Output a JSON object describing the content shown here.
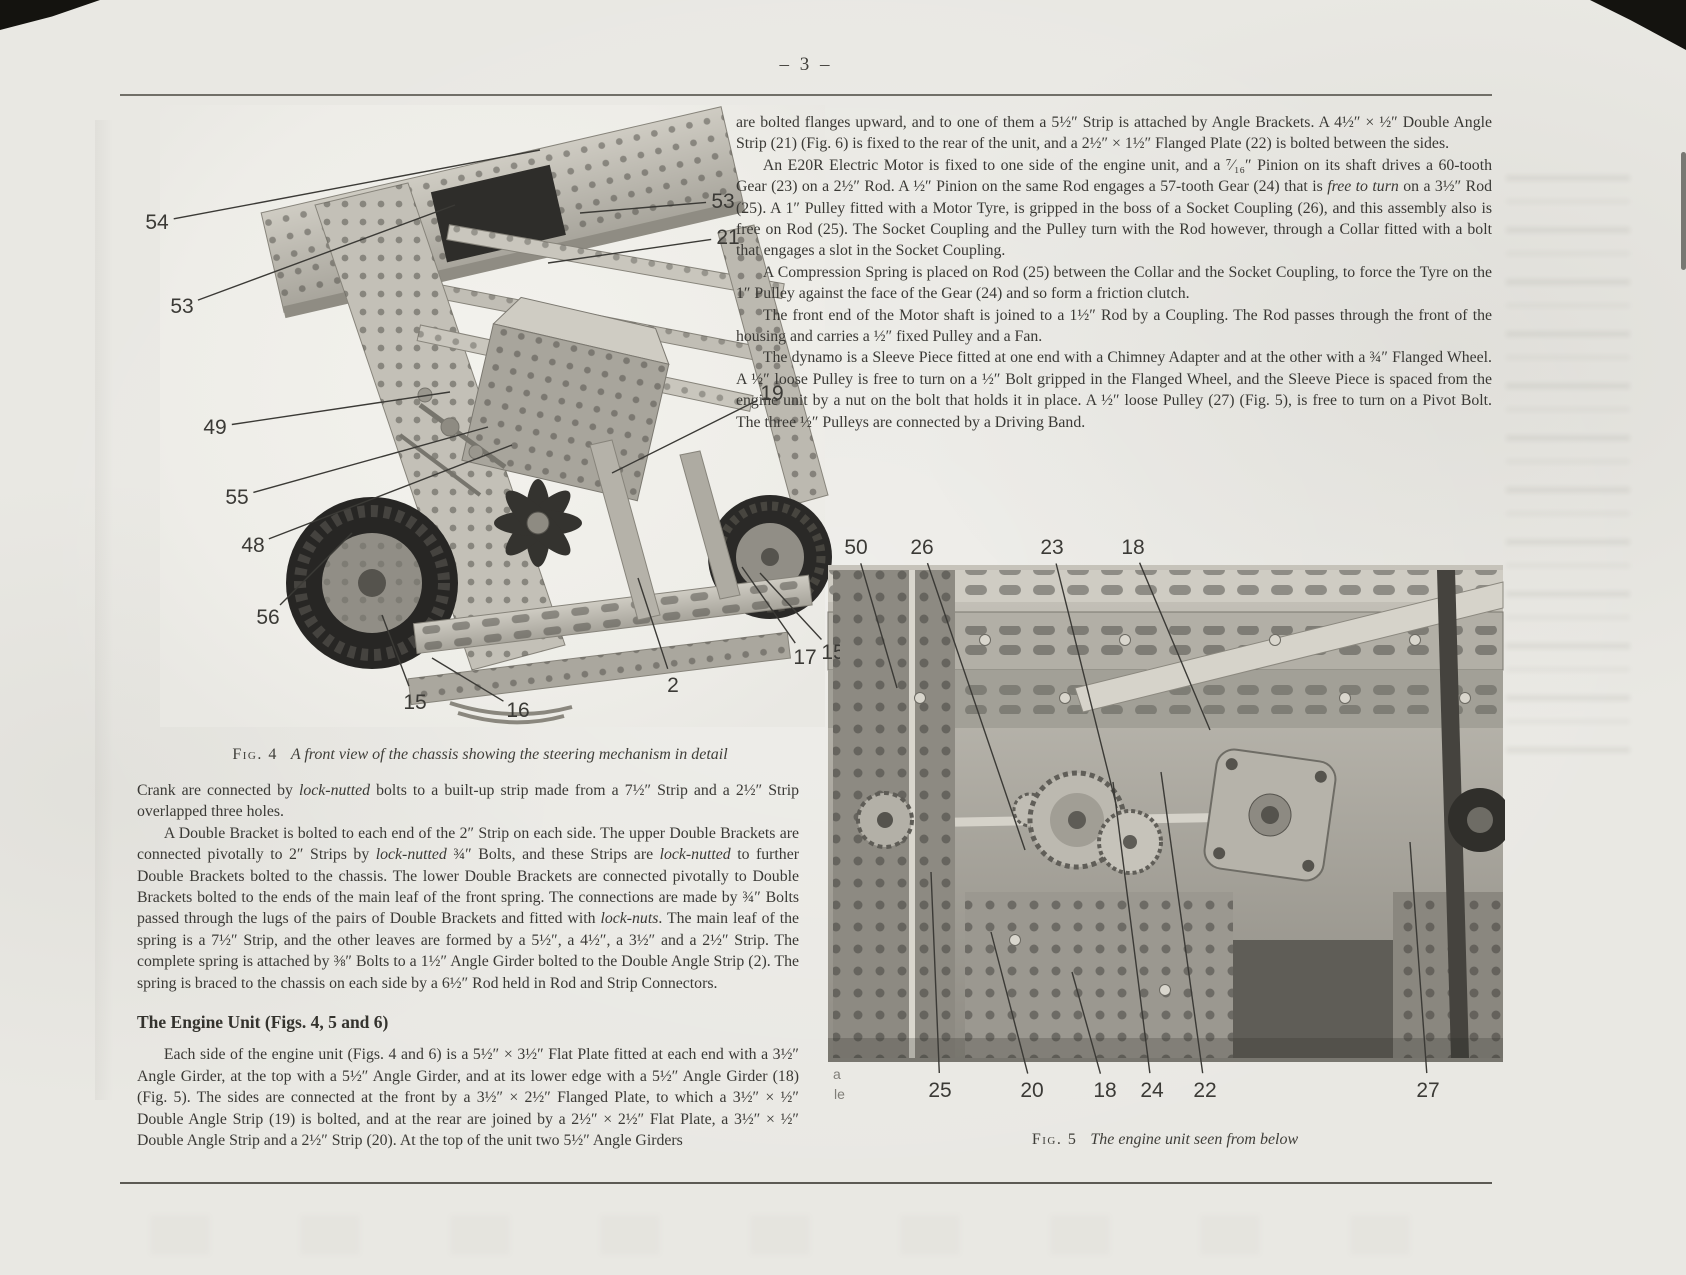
{
  "page": {
    "number": "– 3 –"
  },
  "right_column": {
    "paragraphs": {
      "p1": [
        {
          "t": "are bolted flanges upward, and to one of them a 5½″ Strip is attached by Angle Brackets. A 4½″ × ½″ Double Angle Strip (21) (Fig. 6) is fixed to the rear of the unit, and a 2½″ × 1½″ Flanged Plate (22) is bolted between the sides."
        }
      ],
      "p2": [
        {
          "t": "An E20R Electric Motor is fixed to one side of the engine unit, and a ⁷⁄₁₆″ Pinion on its shaft drives a 60-tooth Gear (23) on a 2½″ Rod. A ½″ Pinion on the same Rod engages a 57-tooth Gear (24) that is "
        },
        {
          "t": "free to turn",
          "i": true
        },
        {
          "t": " on a 3½″ Rod (25). A 1″ Pulley fitted with a Motor Tyre, is gripped in the boss of a Socket Coupling (26), and this assembly also is free on Rod (25). The Socket Coupling and the Pulley turn with the Rod however, through a Collar fitted with a bolt that engages a slot in the Socket Coupling."
        }
      ],
      "p3": [
        {
          "t": "A Compression Spring is placed on Rod (25) between the Collar and the Socket Coupling, to force the Tyre on the 1″ Pulley against the face of the Gear (24) and so form a friction clutch."
        }
      ],
      "p4": [
        {
          "t": "The front end of the Motor shaft is joined to a 1½″ Rod by a Coupling. The Rod passes through the front of the housing and carries a ½″ fixed Pulley and a Fan."
        }
      ],
      "p5": [
        {
          "t": "The dynamo is a Sleeve Piece fitted at one end with a Chimney Adapter and at the other with a ¾″ Flanged Wheel. A ½″ loose Pulley is free to turn on a ½″ Bolt gripped in the Flanged Wheel, and the Sleeve Piece is spaced from the engine unit by a nut on the bolt that holds it in place. A ½″ loose Pulley (27) (Fig. 5), is free to turn on a Pivot Bolt. The three ½″ Pulleys are connected by a Driving Band."
        }
      ]
    }
  },
  "left_column": {
    "heading": "The Engine Unit (Figs. 4, 5 and 6)",
    "paragraphs": {
      "p1": [
        {
          "t": "Crank are connected by "
        },
        {
          "t": "lock-nutted",
          "i": true
        },
        {
          "t": " bolts to a built-up strip made from a 7½″ Strip and a 2½″ Strip overlapped three holes."
        }
      ],
      "p2": [
        {
          "t": "A Double Bracket is bolted to each end of the 2″ Strip on each side. The upper Double Brackets are connected pivotally to 2″ Strips by "
        },
        {
          "t": "lock-nutted",
          "i": true
        },
        {
          "t": " ¾″ Bolts, and these Strips are "
        },
        {
          "t": "lock-nutted",
          "i": true
        },
        {
          "t": " to further Double Brackets bolted to the chassis. The lower Double Brackets are connected pivotally to Double Brackets bolted to the ends of the main leaf of the front spring. The connections are made by ¾″ Bolts passed through the lugs of the pairs of Double Brackets and fitted with "
        },
        {
          "t": "lock-nuts",
          "i": true
        },
        {
          "t": ". The main leaf of the spring is a 7½″ Strip, and the other leaves are formed by a 5½″, a 4½″, a 3½″ and a 2½″ Strip. The complete spring is attached by ⅜″ Bolts to a 1½″ Angle Girder bolted to the Double Angle Strip (2). The spring is braced to the chassis on each side by a 6½″ Rod held in Rod and Strip Connectors."
        }
      ],
      "p3": [
        {
          "t": "Each side of the engine unit (Figs. 4 and 6) is a 5½″ × 3½″ Flat Plate fitted at each end with a 3½″ Angle Girder, at the top with a 5½″ Angle Girder, and at its lower edge with a 5½″ Angle Girder (18) (Fig. 5). The sides are connected at the front by a 3½″ × 2½″ Flanged Plate, to which a 3½″ × ½″ Double Angle Strip (19) is bolted, and at the rear are joined by a 2½″ × 2½″ Flat Plate, a 3½″ × ½″ Double Angle Strip and a 2½″ Strip (20). At the top of the unit two 5½″ Angle Girders"
        }
      ]
    }
  },
  "figures": {
    "fig4": {
      "label": "Fig. 4",
      "caption": "A front view of the chassis showing the steering mechanism in detail",
      "callouts": [
        {
          "n": "54",
          "x": 37,
          "y": 117,
          "ex": 420,
          "ey": 45
        },
        {
          "n": "53",
          "x": 62,
          "y": 201,
          "ex": 335,
          "ey": 100
        },
        {
          "n": "49",
          "x": 95,
          "y": 322,
          "ex": 330,
          "ey": 287
        },
        {
          "n": "55",
          "x": 117,
          "y": 392,
          "ex": 368,
          "ey": 322
        },
        {
          "n": "48",
          "x": 133,
          "y": 440,
          "ex": 392,
          "ey": 340
        },
        {
          "n": "56",
          "x": 148,
          "y": 512,
          "ex": 232,
          "ey": 428
        },
        {
          "n": "53",
          "x": 603,
          "y": 96,
          "ex": 460,
          "ey": 108
        },
        {
          "n": "21",
          "x": 608,
          "y": 132,
          "ex": 428,
          "ey": 158
        },
        {
          "n": "19",
          "x": 652,
          "y": 288,
          "ex": 492,
          "ey": 368
        },
        {
          "n": "15",
          "x": 713,
          "y": 547,
          "ex": 640,
          "ey": 468
        },
        {
          "n": "17",
          "x": 685,
          "y": 552,
          "ex": 622,
          "ey": 462
        },
        {
          "n": "2",
          "x": 553,
          "y": 580,
          "ex": 518,
          "ey": 473
        },
        {
          "n": "16",
          "x": 398,
          "y": 605,
          "ex": 312,
          "ey": 553
        },
        {
          "n": "15",
          "x": 295,
          "y": 597,
          "ex": 262,
          "ey": 510
        }
      ]
    },
    "fig5": {
      "label": "Fig. 5",
      "caption": "The engine unit seen from below",
      "callouts": [
        {
          "n": "50",
          "x": 31,
          "y": 27,
          "ex": 72,
          "ey": 168
        },
        {
          "n": "26",
          "x": 97,
          "y": 27,
          "ex": 200,
          "ey": 330
        },
        {
          "n": "23",
          "x": 227,
          "y": 27,
          "ex": 292,
          "ey": 288
        },
        {
          "n": "18",
          "x": 308,
          "y": 27,
          "ex": 385,
          "ey": 210
        },
        {
          "n": "25",
          "x": 115,
          "y": 570,
          "ex": 106,
          "ey": 352
        },
        {
          "n": "20",
          "x": 207,
          "y": 570,
          "ex": 166,
          "ey": 412
        },
        {
          "n": "18",
          "x": 280,
          "y": 570,
          "ex": 247,
          "ey": 452
        },
        {
          "n": "24",
          "x": 327,
          "y": 570,
          "ex": 288,
          "ey": 262
        },
        {
          "n": "22",
          "x": 380,
          "y": 570,
          "ex": 336,
          "ey": 252
        },
        {
          "n": "27",
          "x": 603,
          "y": 570,
          "ex": 585,
          "ey": 322
        }
      ]
    }
  },
  "artifacts": {
    "bleed1": "a",
    "bleed2": "le"
  },
  "colors": {
    "paper": "#e9e8e3",
    "ink": "#3a3935",
    "rule": "#5c5a54",
    "callout": "#3b3a36"
  }
}
